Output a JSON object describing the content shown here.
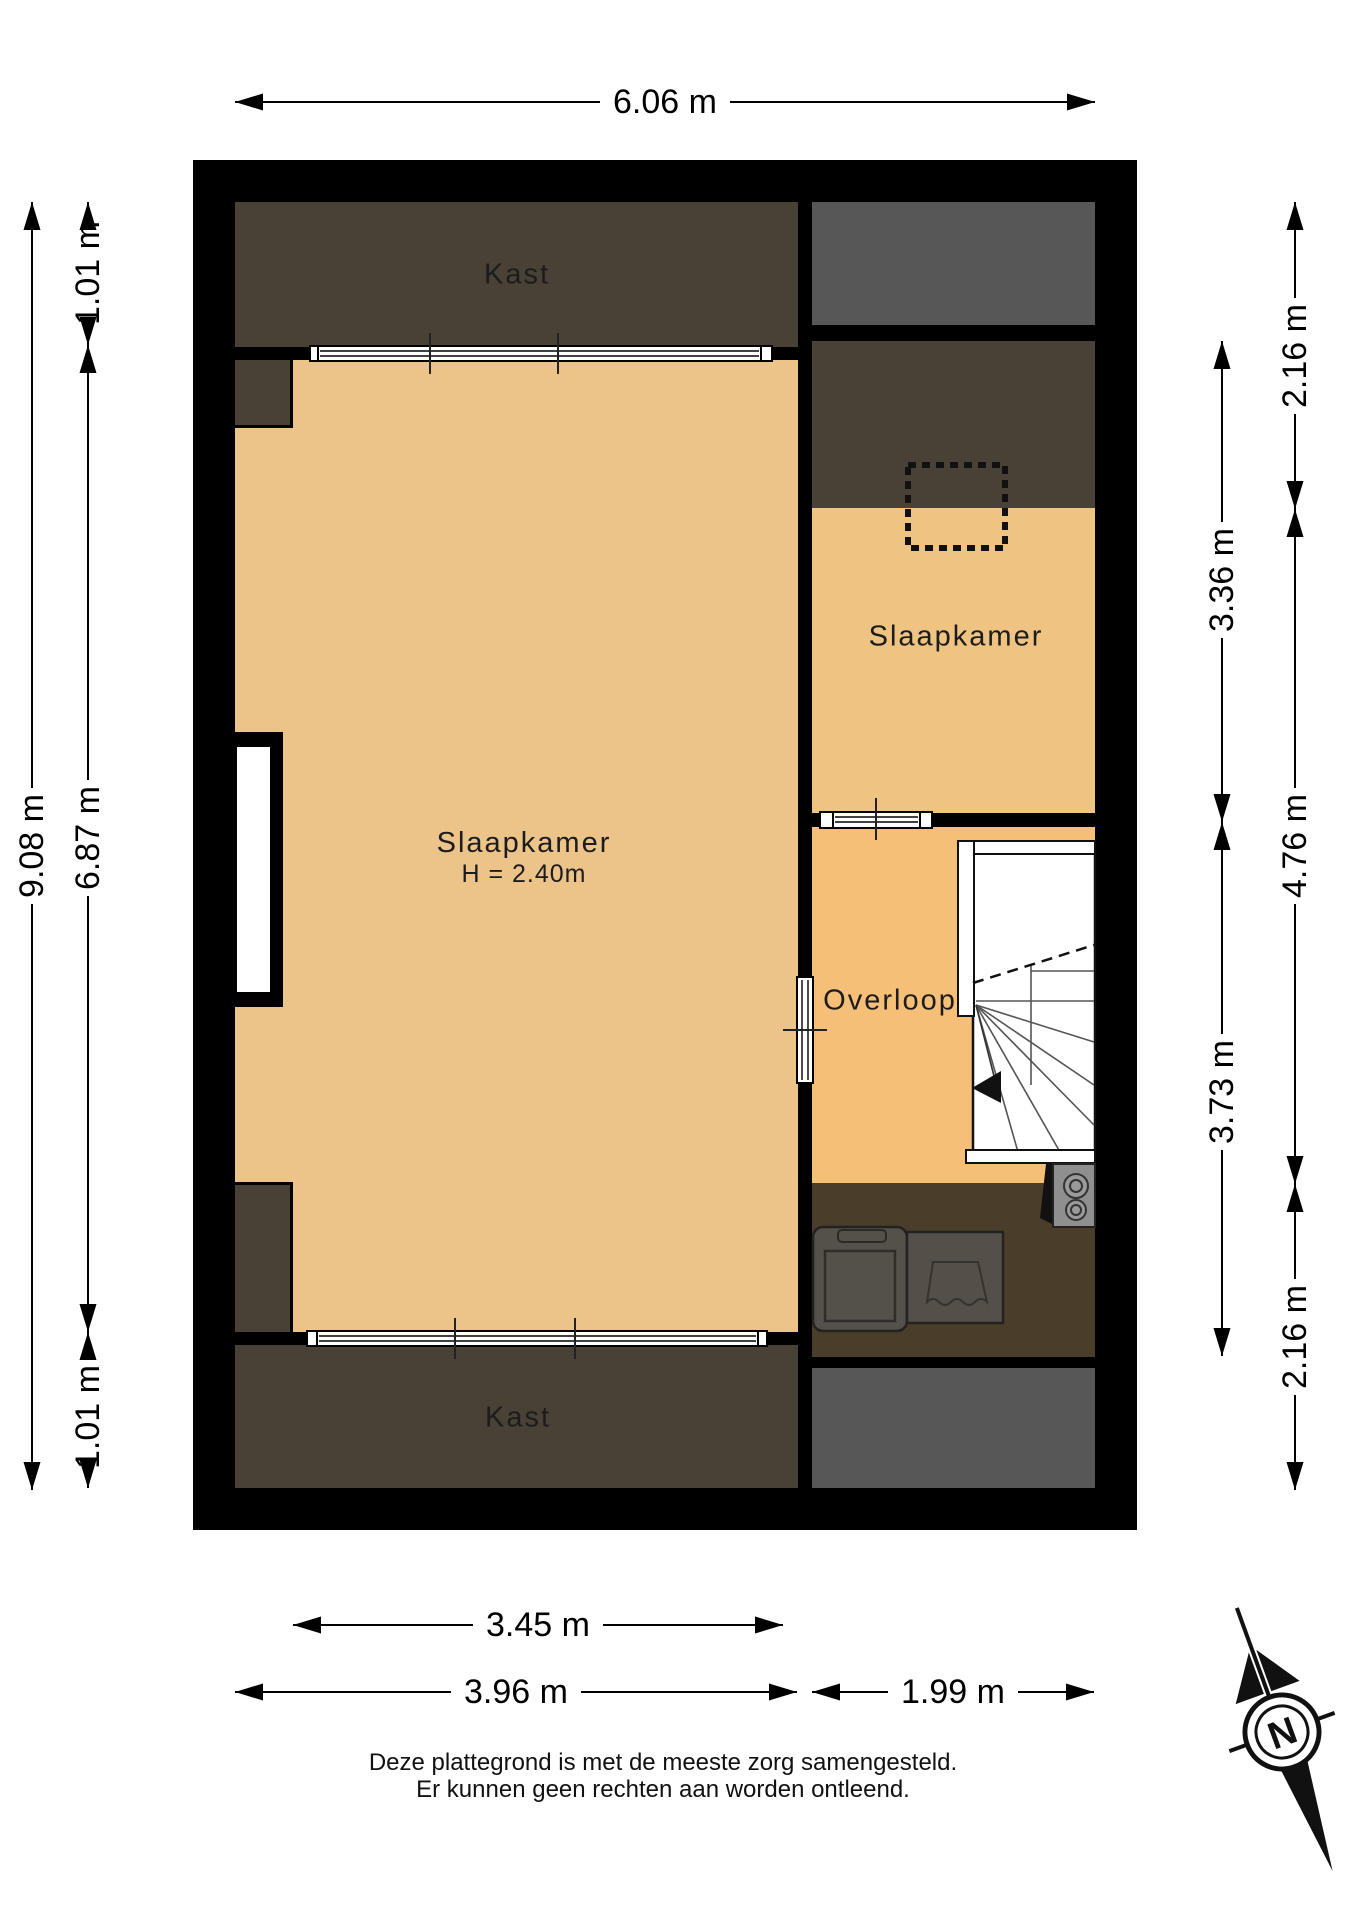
{
  "title": "floor-plan",
  "rooms": {
    "closet_top": {
      "label": "Kast"
    },
    "main_bedroom": {
      "label": "Slaapkamer",
      "height": "H = 2.40m"
    },
    "right_bedroom": {
      "label": "Slaapkamer"
    },
    "landing": {
      "label": "Overloop"
    },
    "closet_bottom": {
      "label": "Kast"
    }
  },
  "dimensions": {
    "top": {
      "label": "6.06 m"
    },
    "left_outer": {
      "label": "9.08 m"
    },
    "left_inner_top": {
      "label": "1.01 m"
    },
    "left_inner_middle": {
      "label": "6.87 m"
    },
    "left_inner_bottom": {
      "label": "1.01 m"
    },
    "right_inner_upper": {
      "label": "3.36 m"
    },
    "right_inner_lower": {
      "label": "3.73 m"
    },
    "right_outer_top": {
      "label": "2.16 m"
    },
    "right_outer_middle": {
      "label": "4.76 m"
    },
    "right_outer_bottom": {
      "label": "2.16 m"
    },
    "bottom_inner": {
      "label": "3.45 m"
    },
    "bottom_left": {
      "label": "3.96 m"
    },
    "bottom_right": {
      "label": "1.99 m"
    }
  },
  "disclaimer": {
    "line1": "Deze plattegrond is met de meeste zorg samengesteld.",
    "line2": "Er kunnen geen rechten aan worden ontleend."
  },
  "compass": {
    "letter": "N"
  },
  "colors": {
    "wall": "#000000",
    "closet_brown": "#4a4136",
    "attic_gray": "#575757",
    "main_floor_tan": "#ecc389",
    "right_floor_tan": "#efc382",
    "landing_tan": "#f5bf78",
    "laundry_brown": "#4a3e2b",
    "window_white": "#ffffff"
  }
}
